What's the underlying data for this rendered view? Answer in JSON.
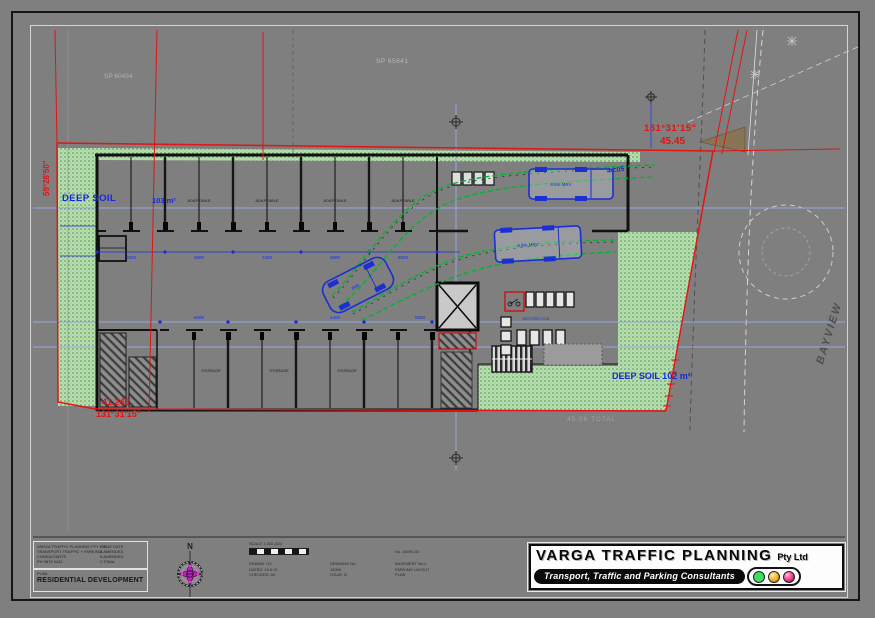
{
  "labels": {
    "deep_soil_left": "DEEP SOIL",
    "deep_soil_left_area": "103 m²",
    "deep_soil_right": "DEEP SOIL  102 m²",
    "bearing_top": "131°31'15\"",
    "dist_top": "45.45",
    "dist_bottom": "41.245",
    "bearing_bottom": "131°31'15\"",
    "bearing_left": "59°28'50\"",
    "dim_4405": "44.05",
    "street_right": "BAYVIEW",
    "total_bottom": "45.06 TOTAL",
    "sp_top": "SP 65841",
    "sp_left": "SP 60434",
    "north": "N",
    "motorcycle": "MOTORCYCLE",
    "truck_label": "8.8m MRV",
    "car_label": "B99",
    "adaptable": "ADAPTABLE",
    "storage": "STORAGE"
  },
  "dims": {
    "row1": [
      "5500",
      "5800",
      "2400",
      "5800",
      "5500"
    ],
    "row2": [
      "6000",
      "2400",
      "5800"
    ]
  },
  "project_box": {
    "firm_lines": [
      "VARGA TRAFFIC PLANNING PTY LTD",
      "TRANSPORT TRAFFIC + PARKING",
      "CONSULTANTS",
      "PH 9876 5432"
    ],
    "issue_lines": [
      "ISSUE  DATE",
      "A  AMENDED",
      "B  AMENDED",
      "C  FINAL"
    ],
    "plan_label": "PLAN:",
    "project_title": "RESIDENTIAL DEVELOPMENT"
  },
  "notes": {
    "scale_title": "SCALE 1:200 (A3)",
    "ref_line": "No. 16090-02",
    "col1": [
      "DRAWN: GV",
      "DATED: 10.6.21",
      "CHECKED: AV"
    ],
    "col2": [
      "DRAWING No.",
      "16090",
      "ISSUE: B"
    ],
    "col3": [
      "BASEMENT No.2",
      "PARKING LAYOUT",
      "PLAN"
    ]
  },
  "title_block": {
    "company": "VARGA TRAFFIC PLANNING",
    "suffix": "Pty Ltd",
    "tagline": "Transport, Traffic and Parking Consultants",
    "lights": {
      "green": "#3ddf63",
      "amber": "#f0a81f",
      "pink": "#e62a7f"
    }
  },
  "colors": {
    "boundary_red": "#e01414",
    "dim_blue": "#1a2fd4",
    "soil_green": "#b7deb0",
    "grid_periwinkle": "#9aa4e6"
  }
}
